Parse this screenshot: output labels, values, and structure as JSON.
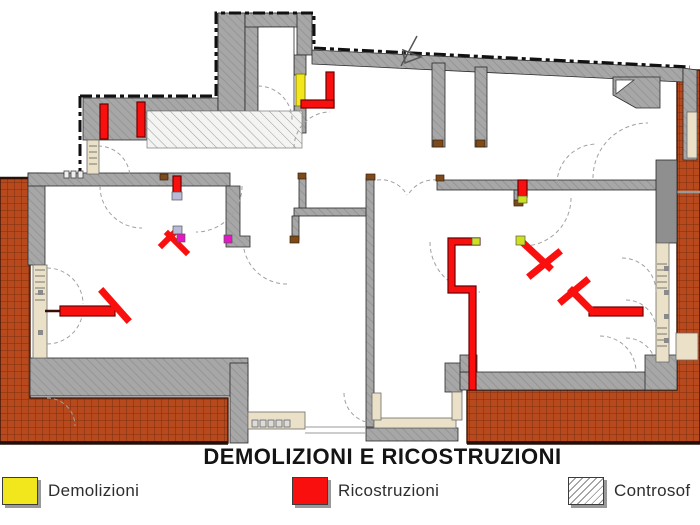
{
  "title": "DEMOLIZIONI E RICOSTRUZIONI",
  "legend": {
    "items": [
      {
        "label": "Demolizioni",
        "fill": "#f2e71c",
        "hatched": false,
        "meaning": "demolitions"
      },
      {
        "label": "Ricostruzioni",
        "fill": "#fa0f0f",
        "hatched": false,
        "meaning": "reconstructions"
      },
      {
        "label": "Controsof",
        "fill": null,
        "hatched": true,
        "meaning": "false-ceiling"
      }
    ]
  },
  "plan": {
    "colors": {
      "wall_gray": "#a7a7a7",
      "wall_hatch_line": "#8e8e8e",
      "dark_wall_gray": "#8f8f8f",
      "brick": "#b8491c",
      "brick_line": "#7c3112",
      "window_beige": "#eae1c8",
      "demolition_yellow": "#f2e71c",
      "reconstruction_red": "#fa0f0f",
      "accent_yellow_green": "#cfe11e",
      "accent_magenta": "#e318c4",
      "accent_lavender": "#b9bad8",
      "outline_black": "#1c1c1c",
      "arc_gray": "#a0a0a0"
    },
    "annotations": [
      "north-arrow"
    ]
  }
}
